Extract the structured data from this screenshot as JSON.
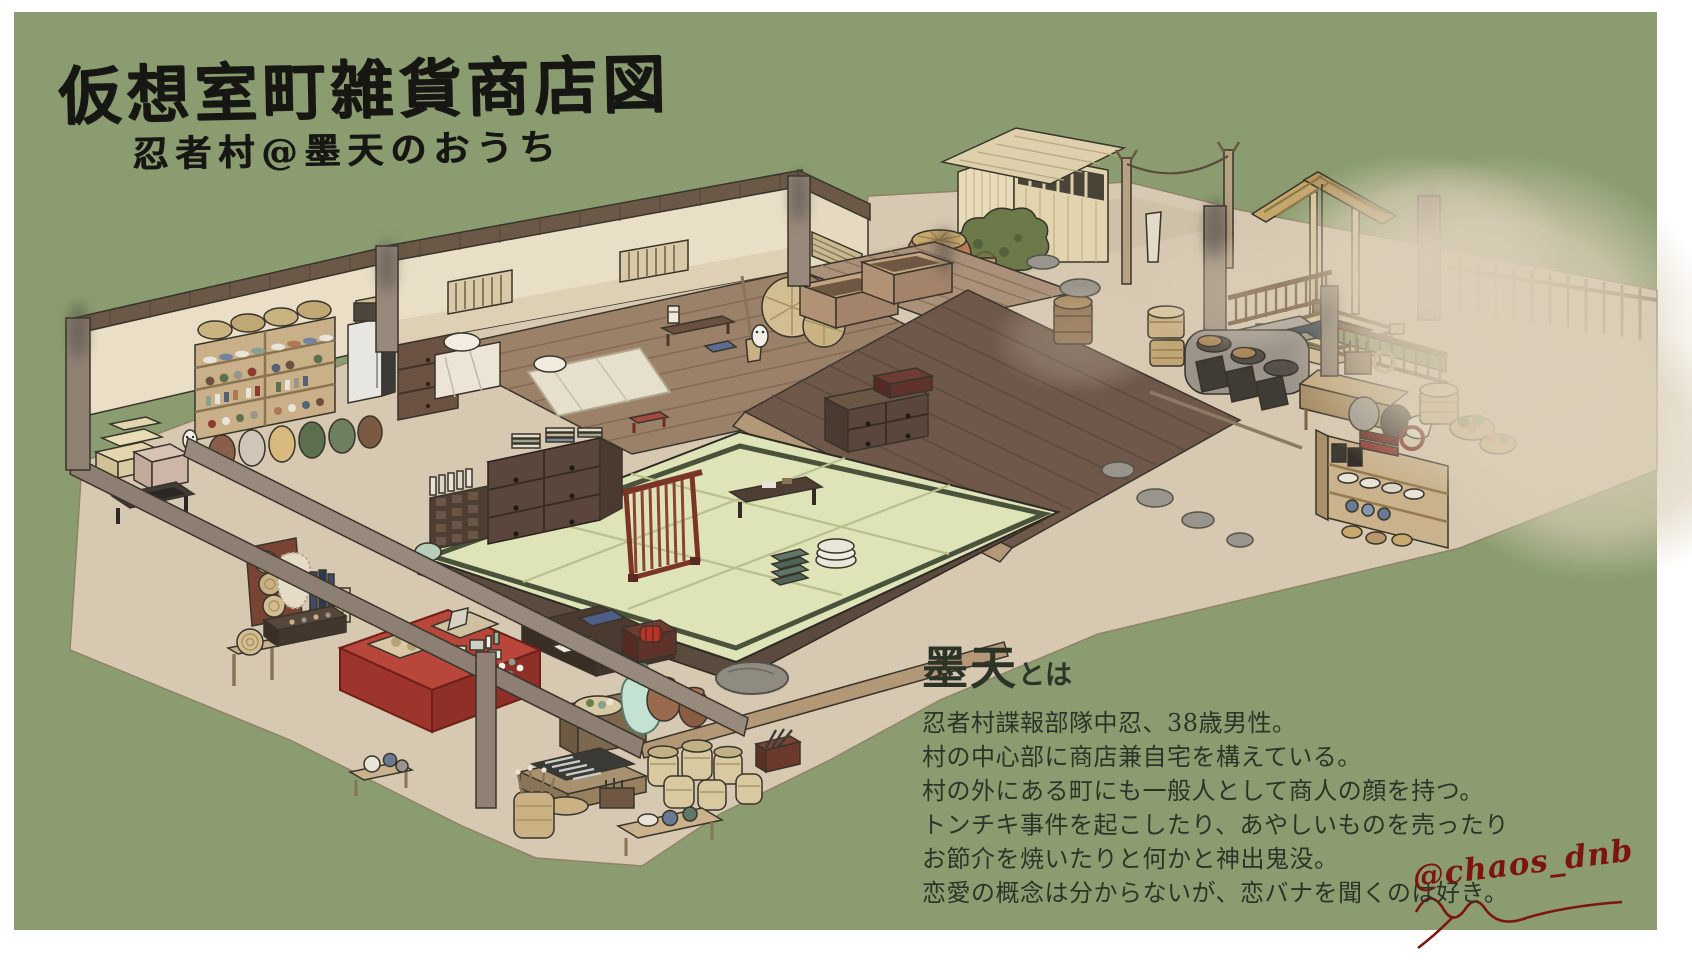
{
  "artwork": {
    "title": "仮想室町雑貨商店図",
    "subtitle": "忍者村@墨天のおうち",
    "profile": {
      "heading_name": "墨天",
      "heading_suffix": "とは",
      "lines": [
        "忍者村諜報部隊中忍、38歳男性。",
        "村の中心部に商店兼自宅を構えている。",
        "村の外にある町にも一般人として商人の顔を持つ。",
        "トンチキ事件を起こしたり、あやしいものを売ったり",
        "お節介を焼いたりと何かと神出鬼没。",
        "恋愛の概念は分からないが、恋バナを聞くのは好き。"
      ]
    },
    "signature": "@chaos_dnb"
  },
  "palette": {
    "background_green": "#8b9d70",
    "paper_border": "#ffffff",
    "ground_beige": "#d7c9b1",
    "deck_light": "#ab9179",
    "deck_medium": "#9c8169",
    "deck_dark": "#6f584a",
    "tatami": "#dfe3b8",
    "tatami_edge": "#49523a",
    "wall_cream": "#e9dec6",
    "beam_brown": "#6b5847",
    "pillar_taupe": "#8f8173",
    "counter_red": "#b8463a",
    "lattice_red": "#7a3428",
    "terracotta": "#bd7a55",
    "celadon": "#c4e2d2",
    "signature_red": "#7c150d",
    "profile_text": "#2c3428"
  },
  "illustration_features": [
    "merchandise-shelf",
    "hanging-pots",
    "rolled-mats",
    "storage-chest",
    "card-drawer-cabinet",
    "book-stacks",
    "white-cabinet",
    "futon-bedding",
    "low-table",
    "blue-cushion",
    "winnow-baskets",
    "wooden-crates",
    "terracotta-jar",
    "garden-bush",
    "storage-shed",
    "clothesline",
    "stone-well",
    "porch-railing",
    "green-railing",
    "bamboo-fence",
    "kamado-stove",
    "kitchen-worktable",
    "dish-shelf",
    "vegetable-baskets",
    "tatami-room",
    "lattice-screen",
    "writing-desk",
    "cushion-stack",
    "towel-stack",
    "shop-desk",
    "celadon-vase",
    "clay-pots",
    "garden-stone",
    "straw-jars",
    "knife-display",
    "red-counter",
    "hat-display-board",
    "fur-pelt",
    "sign-board",
    "display-case",
    "round-stool",
    "stacked-boxes",
    "stepping-stones",
    "broom",
    "ghost-figure"
  ]
}
